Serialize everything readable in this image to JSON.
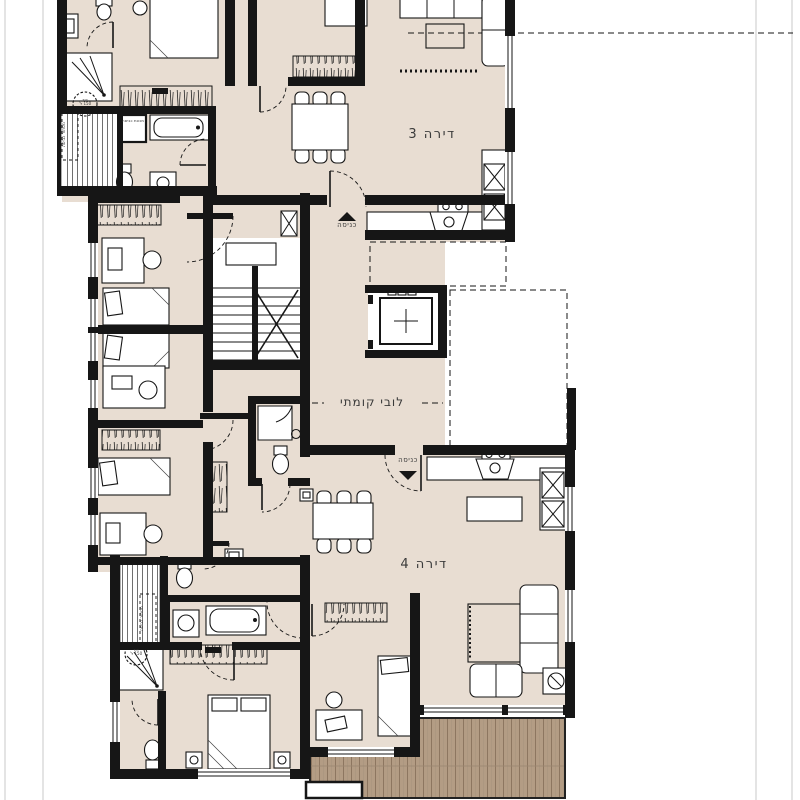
{
  "plan": {
    "title": "apartment-floor-plan",
    "apartments": {
      "apt3": "דירה 3",
      "apt4": "דירה 4"
    },
    "core": {
      "lobby": "לובי קומתי",
      "entrance": "כניסה"
    },
    "fixtures": {
      "washing_machine": "מכונת כביסה",
      "water_heater": "דוד",
      "water_heater_capacity": "150 ל'",
      "laundry_screen": "מסתור כביסה"
    },
    "colors": {
      "wall": "#161616",
      "floor": "#e8ddd2",
      "deck": "#b39c84",
      "deck_stripe": "#8d7660",
      "frame_line": "#c9c9c9",
      "label": "#3a3a3a"
    }
  }
}
